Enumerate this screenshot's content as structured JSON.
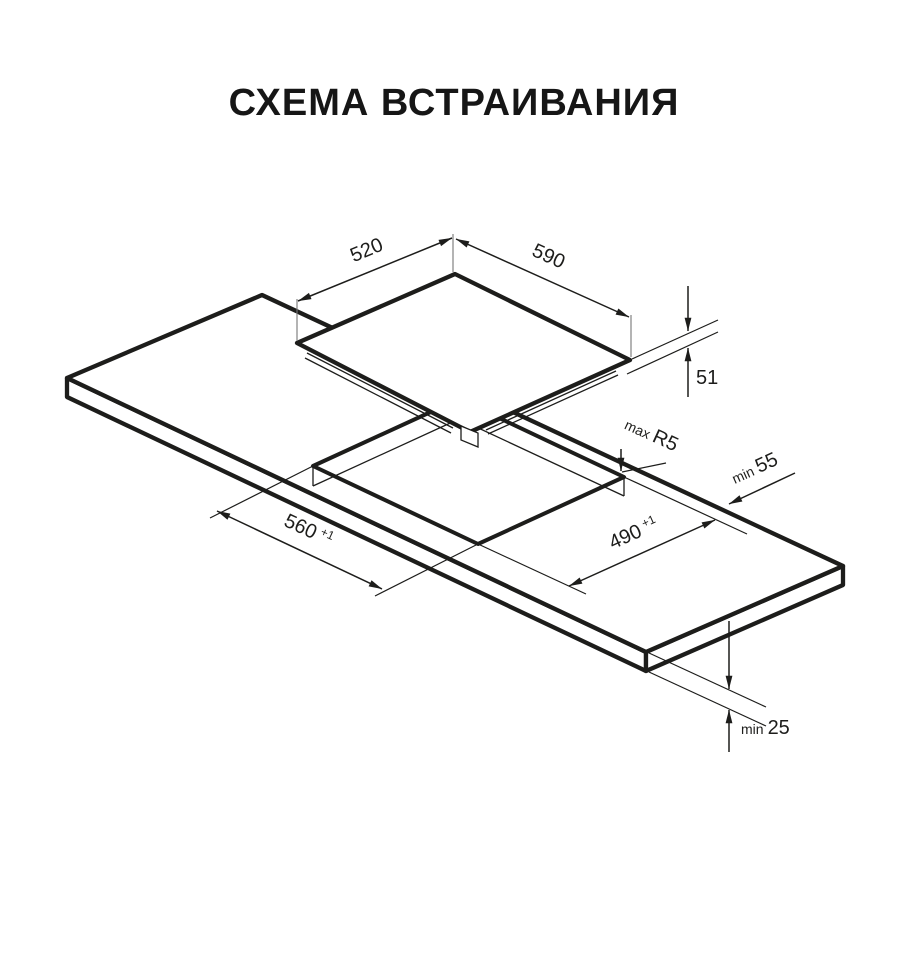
{
  "title": "СХЕМА ВСТРАИВАНИЯ",
  "dimensions": {
    "hob_depth": "520",
    "hob_width": "590",
    "hob_height": "51",
    "cutout_width": "560",
    "cutout_width_tol": "+1",
    "cutout_depth": "490",
    "cutout_depth_tol": "+1",
    "corner_radius_prefix": "max",
    "corner_radius": "R5",
    "side_clearance_prefix": "min",
    "side_clearance": "55",
    "bottom_clearance_prefix": "min",
    "bottom_clearance": "25"
  },
  "colors": {
    "line": "#1d1d1b",
    "background": "#ffffff"
  }
}
